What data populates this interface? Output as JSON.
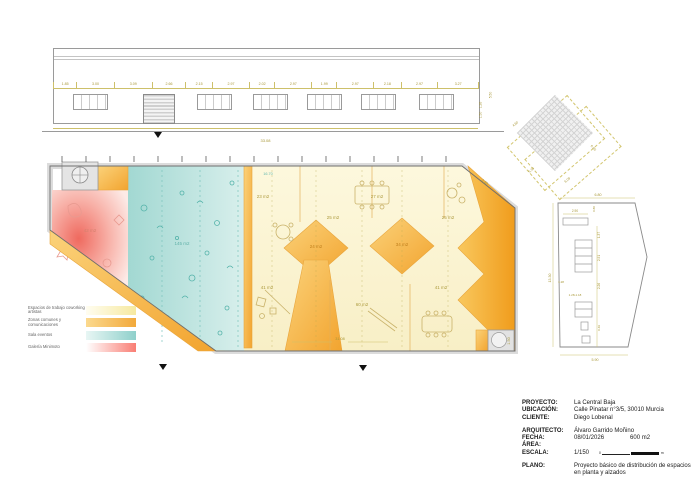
{
  "colors": {
    "dim_text": "#a89737",
    "amber": "#f3a32c",
    "amber_light": "#fbcf6b",
    "pale_yellow": "#fbf5d3",
    "teal": "#a8dcd6",
    "red": "#ef6a5f",
    "wall_gray": "#8a8a8a"
  },
  "front_elevation": {
    "dim_segments": [
      "1.85",
      "3.00",
      "3.09",
      "2.66",
      "2.15",
      "2.97",
      "2.02",
      "2.97",
      "1.99",
      "2.97",
      "2.18",
      "2.97",
      "3.27"
    ],
    "overall_dim": "33.08",
    "right_dims": {
      "d1": "5.50",
      "d2": "1.26",
      "d3": "1.50"
    }
  },
  "floor_plan": {
    "rooms": [
      {
        "label": "42 m2"
      },
      {
        "label": "145 m2"
      },
      {
        "label": "23 m2"
      },
      {
        "label": "25 m2"
      },
      {
        "label": "24 m2"
      },
      {
        "label": "27 m2"
      },
      {
        "label": "25 m2"
      },
      {
        "label": "34 m2"
      },
      {
        "label": "41 m2"
      },
      {
        "label": "60 m2"
      },
      {
        "label": "41 m2"
      }
    ],
    "dims": {
      "bottom": "31.08",
      "top_inner": "16.70",
      "chamfer": "3.80",
      "wc": "1.50"
    }
  },
  "roof_plan": {
    "dims": {
      "d1": "4.60",
      "d2": "5.33",
      "d3": "6.09",
      "d4": "6.80"
    }
  },
  "side_elevation": {
    "dims": {
      "top": "6.80",
      "left": "13.30",
      "bottom": "5.90",
      "w1": "2.90",
      "w2": "0.80",
      "c1": "1.37",
      "c2": "2.91",
      "c3": "2.26",
      "c4": "1.28",
      "c5": "1.28-1.18",
      "c6": "0.49"
    }
  },
  "legend": {
    "items": [
      {
        "label": "Espacios de trabajo coworking artistas",
        "from": "#fffdf0",
        "to": "#f6e9a0"
      },
      {
        "label": "Zonas comunes y comunicaciones",
        "from": "#fbd98e",
        "to": "#f2a93b"
      },
      {
        "label": "Sala eventos",
        "from": "#e8f6f4",
        "to": "#8fd0cb"
      },
      {
        "label": "Galería Minimoto",
        "from": "#ffffff",
        "to": "#f97e74"
      }
    ]
  },
  "title_block": {
    "proyecto_label": "PROYECTO:",
    "proyecto": "La Central Baja",
    "ubicacion_label": "UBICACIÓN:",
    "ubicacion": "Calle Pinatar n°3/5, 30010 Murcia",
    "cliente_label": "CLIENTE:",
    "cliente": "Diego Lobenal",
    "arquitecto_label": "ARQUITECTO:",
    "arquitecto": "Álvaro Garrido Moñino",
    "fecha_label": "FECHA:",
    "fecha": "08/01/2026",
    "area_label": "ÁREA:",
    "area_value": "600 m2",
    "escala_label": "ESCALA:",
    "escala": "1/150",
    "scale_zero": "0",
    "scale_unit": "m",
    "plano_label": "PLANO:",
    "plano": "Proyecto básico de distribución de espacios en planta y alzados"
  }
}
